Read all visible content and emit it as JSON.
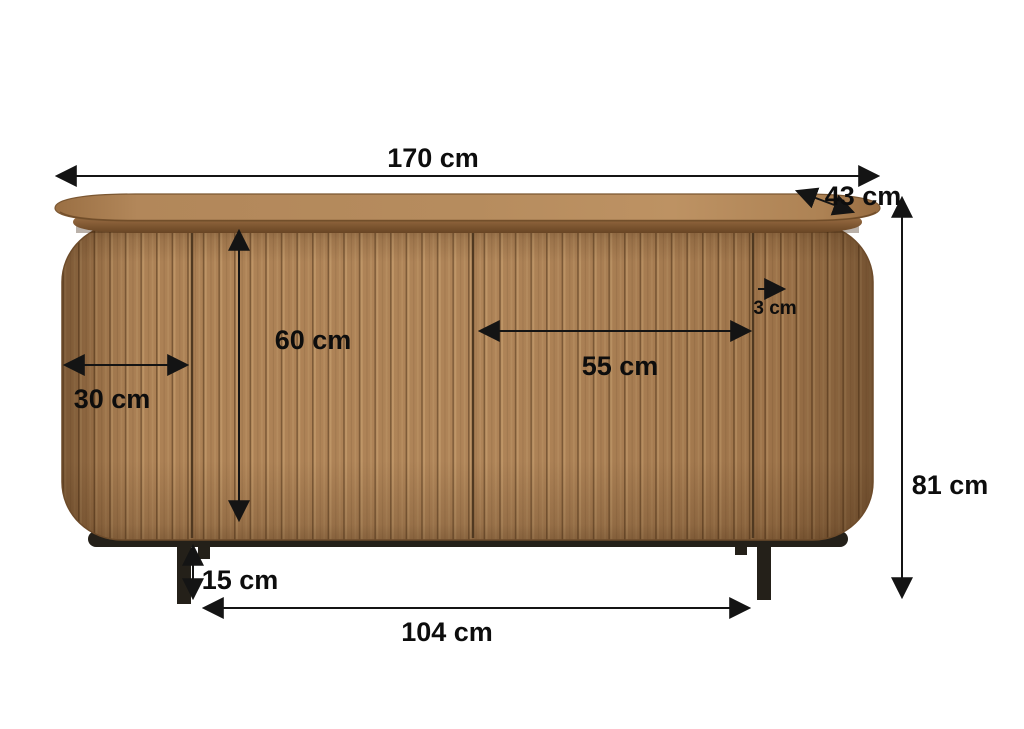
{
  "diagram": {
    "subject": "sideboard with slatted wood front, rounded ends and black metal legs",
    "unit": "cm",
    "dimensions": {
      "overall_width": "170 cm",
      "top_depth": "43 cm",
      "overall_height": "81 cm",
      "door_height": "60 cm",
      "door_width": "55 cm",
      "side_section_width": "30 cm",
      "panel_thickness": "3 cm",
      "leg_height": "15 cm",
      "leg_spacing": "104 cm"
    },
    "colors": {
      "background": "#ffffff",
      "wood_mid": "#a87c50",
      "wood_light": "#c59c6d",
      "wood_groove": "#74512f",
      "top_surface": "#b68c5e",
      "frame_black": "#242019",
      "dimension_line": "#141414"
    }
  }
}
